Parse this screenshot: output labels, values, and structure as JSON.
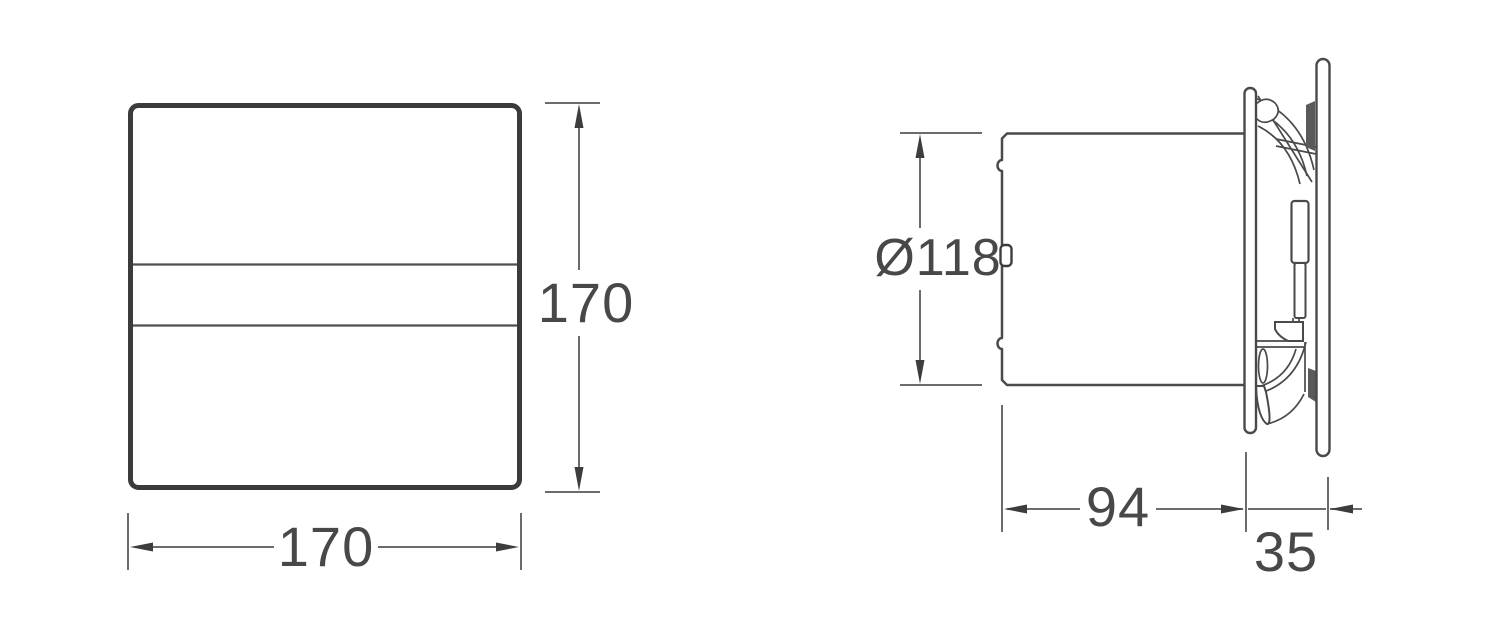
{
  "drawing": {
    "title": "fan-dimension-drawing",
    "front_view": {
      "width_label": "170",
      "height_label": "170"
    },
    "side_view": {
      "diameter_label": "Ø118",
      "depth_label": "94",
      "panel_depth_label": "35"
    }
  },
  "colors": {
    "background": "#ffffff",
    "outline_strong": "#3b3b3b",
    "outline": "#4a4a4a",
    "dimension_line": "#6b6b6b",
    "arrow": "#3d3d3d",
    "text": "#484848"
  }
}
